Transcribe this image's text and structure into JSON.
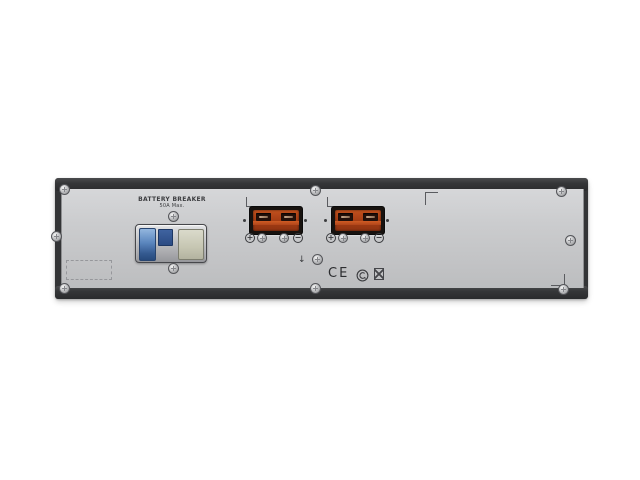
{
  "scene": {
    "description": "Rear panel of a 2U rack-mount UPS battery pack on white background"
  },
  "panel": {
    "breaker_label": {
      "line1": "BATTERY BREAKER",
      "line2": "50A Max."
    },
    "terminals": {
      "plus_symbol": "+",
      "minus_symbol": "−"
    },
    "ground_arrow_symbol": "↓",
    "certifications": {
      "ce_text": "CE"
    }
  },
  "colors": {
    "frame_dark": "#333436",
    "panel_gray": "#c9cacc",
    "connector_orange": "#b5481c",
    "connector_slot_dark": "#23100a",
    "breaker_blue": "#4a77b4",
    "breaker_beige": "#ccccba",
    "screw_silver": "#c2c3c5"
  }
}
